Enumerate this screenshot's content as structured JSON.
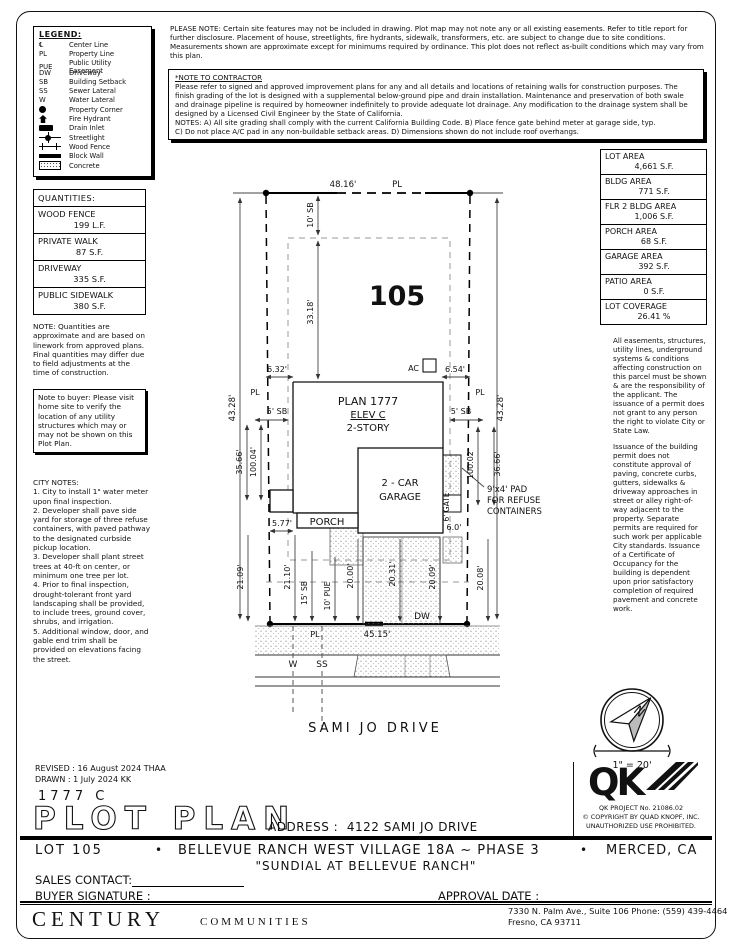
{
  "sheet": {
    "please_note": "PLEASE NOTE:  Certain site features may not be included in drawing. Plot map may not note any or all existing easements. Refer to title report for further disclosure. Placement of house, streetlights, fire hydrants, sidewalk, transformers, etc. are subject to change due to site conditions. Measurements shown are approximate except for minimums required by ordinance. This plot does not reflect as-built conditions which may vary from this plan.",
    "contractor_note_title": "*NOTE TO CONTRACTOR",
    "contractor_note_body": "Please refer to signed and approved improvement plans for any and all details and locations of retaining walls for construction purposes. The finish grading of the lot is designed with a supplemental below-ground pipe and drain installation. Maintenance and preservation of both swale and drainage pipeline is required by homeowner indefinitely to provide adequate lot drainage. Any modification to the drainage system shall be designed by a Licensed Civil Engineer by the State of California.\nNOTES:  A) All site grading shall comply with the current California Building Code.  B) Place fence gate behind meter at garage side, typ.\nC) Do not place A/C pad in any non-buildable setback areas.  D) Dimensions shown do not include roof overhangs."
  },
  "legend": {
    "title": "LEGEND:",
    "items": [
      {
        "symbol": "℄",
        "label": "Center Line"
      },
      {
        "symbol": "PL",
        "label": "Property Line"
      },
      {
        "symbol": "PUE",
        "label": "Public Utility Easement"
      },
      {
        "symbol": "DW",
        "label": "Driveway"
      },
      {
        "symbol": "SB",
        "label": "Building Setback"
      },
      {
        "symbol": "SS",
        "label": "Sewer Lateral"
      },
      {
        "symbol": "W",
        "label": "Water Lateral"
      },
      {
        "icon": "property-corner-icon",
        "label": "Property Corner"
      },
      {
        "icon": "fire-hydrant-icon",
        "label": "Fire Hydrant"
      },
      {
        "icon": "drain-inlet-icon",
        "label": "Drain Inlet"
      },
      {
        "icon": "streetlight-icon",
        "label": "Streetlight"
      },
      {
        "icon": "wood-fence-icon",
        "label": "Wood Fence"
      },
      {
        "icon": "block-wall-icon",
        "label": "Block Wall"
      },
      {
        "icon": "concrete-icon",
        "label": "Concrete"
      }
    ]
  },
  "quantities": {
    "title": "QUANTITIES:",
    "rows": [
      {
        "name": "WOOD FENCE",
        "value": "199 L.F."
      },
      {
        "name": "PRIVATE WALK",
        "value": "87 S.F."
      },
      {
        "name": "DRIVEWAY",
        "value": "335 S.F."
      },
      {
        "name": "PUBLIC SIDEWALK",
        "value": "380 S.F."
      }
    ],
    "note": "NOTE: Quantities are approximate and are based on linework from approved plans.  Final quantities may differ due to field adjustments at the time of construction."
  },
  "buyer_note": "Note to buyer: Please visit home site to verify the location of any utility structures which may or may not be shown on this Plot Plan.",
  "city_notes": {
    "title": "CITY NOTES:",
    "body": "1. City to install 1\" water meter upon final inspection.\n2. Developer shall pave side yard for storage of three refuse containers, with paved pathway to the designated curbside pickup location.\n3. Developer shall plant street trees at 40-ft on center, or minimum one tree per lot.\n4. Prior to final inspection, drought-tolerant front yard landscaping shall be provided, to include trees, ground cover, shrubs, and irrigation.\n5. Additional window, door, and gable end trim shall be provided on elevations facing the street."
  },
  "areas": {
    "rows": [
      {
        "name": "LOT AREA",
        "value": "4,661 S.F."
      },
      {
        "name": "BLDG AREA",
        "value": "771 S.F."
      },
      {
        "name": "FLR 2 BLDG AREA",
        "value": "1,006 S.F."
      },
      {
        "name": "PORCH AREA",
        "value": "68 S.F."
      },
      {
        "name": "GARAGE AREA",
        "value": "392 S.F."
      },
      {
        "name": "PATIO AREA",
        "value": "0 S.F."
      },
      {
        "name": "LOT COVERAGE",
        "value": "26.41 %"
      }
    ]
  },
  "side_notes": {
    "para1": "All easements, structures, utility lines, underground systems & conditions affecting construction on this parcel must be shown & are the responsibility of the applicant. The issuance of a permit does not grant to any person the right to violate City or State Law.",
    "para2": "Issuance of the building permit does not constitute approval of paving, concrete curbs, gutters, sidewalks & driveway approaches in street or alley right-of-way adjacent to the property. Separate permits are required for such work per applicable City standards. Issuance of a Certificate of Occupancy for the building is dependent upon prior satisfactory completion of required pavement and concrete work."
  },
  "plot": {
    "lot_number": "105",
    "plan": "PLAN 1777",
    "elev": "ELEV C",
    "story": "2-STORY",
    "porch": "PORCH",
    "garage_line1": "2 - CAR",
    "garage_line2": "GARAGE",
    "gate": "6' GATE",
    "gate_dim": "6.0'",
    "ac": "AC",
    "dw": "DW",
    "pad_line1": "9'x4' PAD",
    "pad_line2": "FOR REFUSE",
    "pad_line3": "CONTAINERS",
    "street": "SAMI JO DRIVE",
    "pl": "PL",
    "w": "W",
    "ss": "SS",
    "dims": {
      "top": "48.16'",
      "left": "43.28'",
      "right": "43.28'",
      "sb_top": "10' SB",
      "depth": "33.18'",
      "d632": "6.32'",
      "d654": "6.54'",
      "sb_left": "5' SB",
      "sb_right": "5' SB",
      "d3566": "35.66'",
      "d10004": "100.04'",
      "d10002": "100.02'",
      "d3666": "36.66'",
      "d577": "5.77'",
      "d2109": "21.09'",
      "d2110": "21.10'",
      "sb_bottom": "15' SB",
      "pue": "10' PUE",
      "d2000": "20.00'",
      "d2031": "20.31'",
      "d2009": "20.09'",
      "d2008": "20.08'",
      "frontage": "45.15'"
    }
  },
  "compass": {
    "north": "N",
    "scale": "1\" = 20'"
  },
  "qk": {
    "logo": "QK",
    "project": "QK PROJECT No. 21086.02",
    "copyright1": "© COPYRIGHT BY QUAD KNOPF, INC.",
    "copyright2": "UNAUTHORIZED USE PROHIBITED."
  },
  "title_block": {
    "revised_label": "REVISED :",
    "revised": "16 August 2024  THAA",
    "drawn_label": "DRAWN :",
    "drawn": "1 July 2024  KK",
    "plan_code": "1777    C",
    "title": "PLOT PLAN",
    "address_label": "ADDRESS :",
    "address": "4122 SAMI JO DRIVE"
  },
  "footer": {
    "lot": "LOT 105",
    "bullet": "•",
    "community": "BELLEVUE RANCH WEST VILLAGE 18A ~ PHASE 3",
    "city": "MERCED, CA",
    "subtitle": "\"SUNDIAL AT BELLEVUE RANCH\"",
    "sales_contact": "SALES CONTACT:",
    "buyer_signature": "BUYER SIGNATURE :",
    "approval_date": "APPROVAL DATE :",
    "company_main": "CENTURY",
    "company_sub": "COMMUNITIES",
    "office_line1": "7330 N. Palm Ave., Suite 106    Phone:  (559) 439-4464",
    "office_line2": "Fresno, CA  93711"
  }
}
